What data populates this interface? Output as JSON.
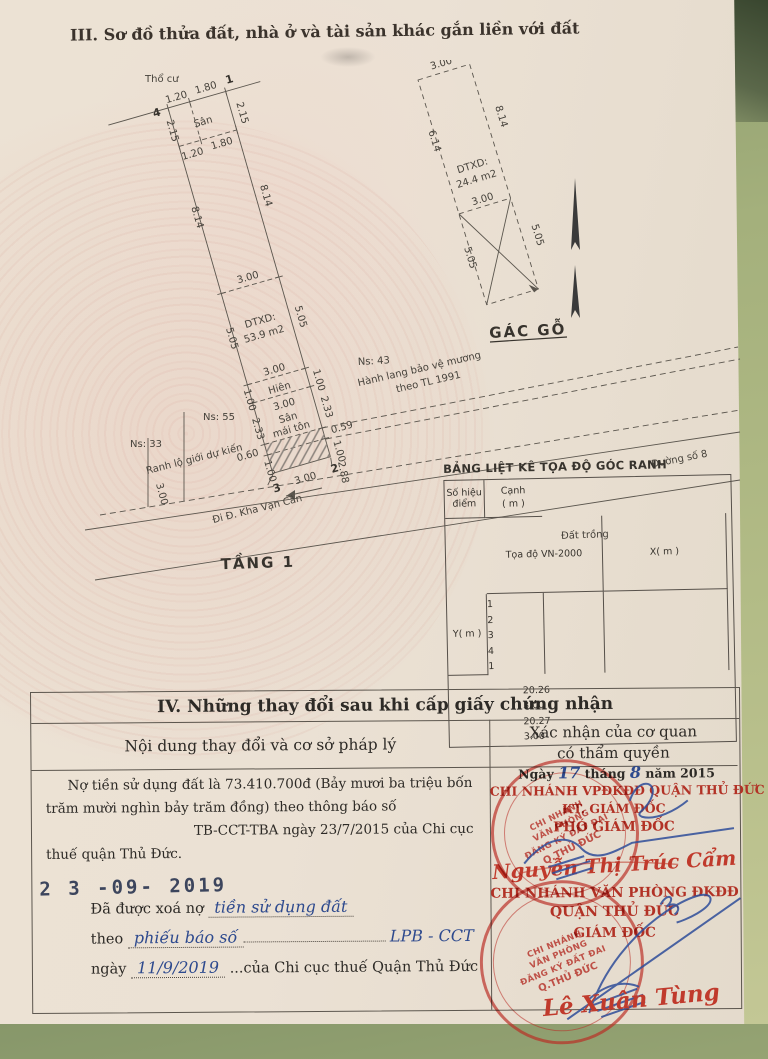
{
  "page_title": "III. Sơ đồ thửa đất, nhà ở và tài sản khác gắn liền với đất",
  "plot": {
    "tho_cu": "Thổ cư",
    "san": "Sân",
    "dtxd_label": "DTXD:",
    "dtxd_value": "53.9 m2",
    "hien": "Hiên",
    "san_mai_ton_1": "Sân",
    "san_mai_ton_2": "mái tôn",
    "tang1": "TẦNG 1",
    "ns43": "Ns: 43",
    "ns55": "Ns: 55",
    "ns33": "Ns: 33",
    "hanh_lang_1": "Hành lang bảo vệ mương",
    "hanh_lang_2": "theo TL 1991",
    "ranh_lo_gioi": "Ranh lộ giới dự kiến",
    "duong_so_8": "Đường số 8",
    "kha_van_can": "Đi Đ. Kha Vạn Cân",
    "dat_trong": "Đất trồng",
    "corner1": "1",
    "corner2": "2",
    "corner3": "3",
    "corner4": "4"
  },
  "dims": {
    "d059": "0.59",
    "d060": "0.60",
    "d100": "1.00",
    "d120": "1.20",
    "d180": "1.80",
    "d215": "2.15",
    "d233": "2.33",
    "d288": "2.88",
    "d300": "3.00",
    "d505": "5.05",
    "d614": "6.14",
    "d814": "8.14"
  },
  "gac_go": {
    "title": "GÁC GỖ",
    "dtxd_label": "DTXD:",
    "dtxd_value": "24.4 m2"
  },
  "coord_table": {
    "title": "BẢNG LIỆT KÊ TỌA ĐỘ GÓC RANH",
    "col_point_1": "Số hiệu",
    "col_point_2": "điểm",
    "col_coord": "Tọa độ VN-2000",
    "col_x": "X( m )",
    "col_y": "Y( m )",
    "col_edge_1": "Cạnh",
    "col_edge_2": "( m )",
    "p1": "1",
    "p2": "2",
    "p3": "3",
    "p4": "4",
    "p5": "1",
    "e1": "20.26",
    "e2": "3.00",
    "e3": "20.27",
    "e4": "3.00"
  },
  "section4": {
    "title": "IV. Những thay đổi sau khi cấp giấy chứng nhận",
    "header_left": "Nội dung thay đổi và cơ sở pháp lý",
    "header_right_1": "Xác nhận của cơ quan",
    "header_right_2": "có thẩm quyền",
    "debt_text": "Nợ tiền sử dụng đất là 73.410.700đ (Bảy mươi ba triệu bốn trăm mười nghìn bảy trăm đồng) theo thông báo số",
    "debt_text_2": "TB-CCT-TBA ngày 23/7/2015 của Chi cục thuế quận Thủ Đức.",
    "date_stamp": "2 3 -09- 2019",
    "cleared_label": "Đã được xoá nợ",
    "cleared_hw": "tiền sử dụng đất",
    "theo_label": "theo",
    "theo_hw": "phiếu báo số",
    "theo_hw2": "LPB - CCT",
    "ngay_label": "ngày",
    "ngay_hw": "11/9/2019",
    "ngay_suffix": "...của Chi cục thuế Quận Thủ Đức",
    "right": {
      "date_prefix": "Ngày",
      "date_day": "17",
      "date_thang": "tháng",
      "date_month": "8",
      "date_year": "năm 2015",
      "office1": "CHI NHÁNH VPĐKĐĐ QUẬN THỦ ĐỨC",
      "kt": "KT. GIÁM ĐỐC",
      "pho": "PHÓ GIÁM ĐỐC",
      "signer1": "Nguyễn Thị Trúc Cẩm",
      "office2": "CHI NHÁNH VĂN PHÒNG ĐKĐĐ",
      "office2b": "QUẬN THỦ ĐỨC",
      "gd": "GIÁM ĐỐC",
      "signer2": "Lê Xuân Tùng",
      "stamp1": "CHI NHÁNH",
      "stamp2": "VĂN PHÒNG",
      "stamp3": "ĐĂNG KÝ ĐẤT ĐAI",
      "stamp4": "Q.THỦ ĐỨC"
    }
  }
}
